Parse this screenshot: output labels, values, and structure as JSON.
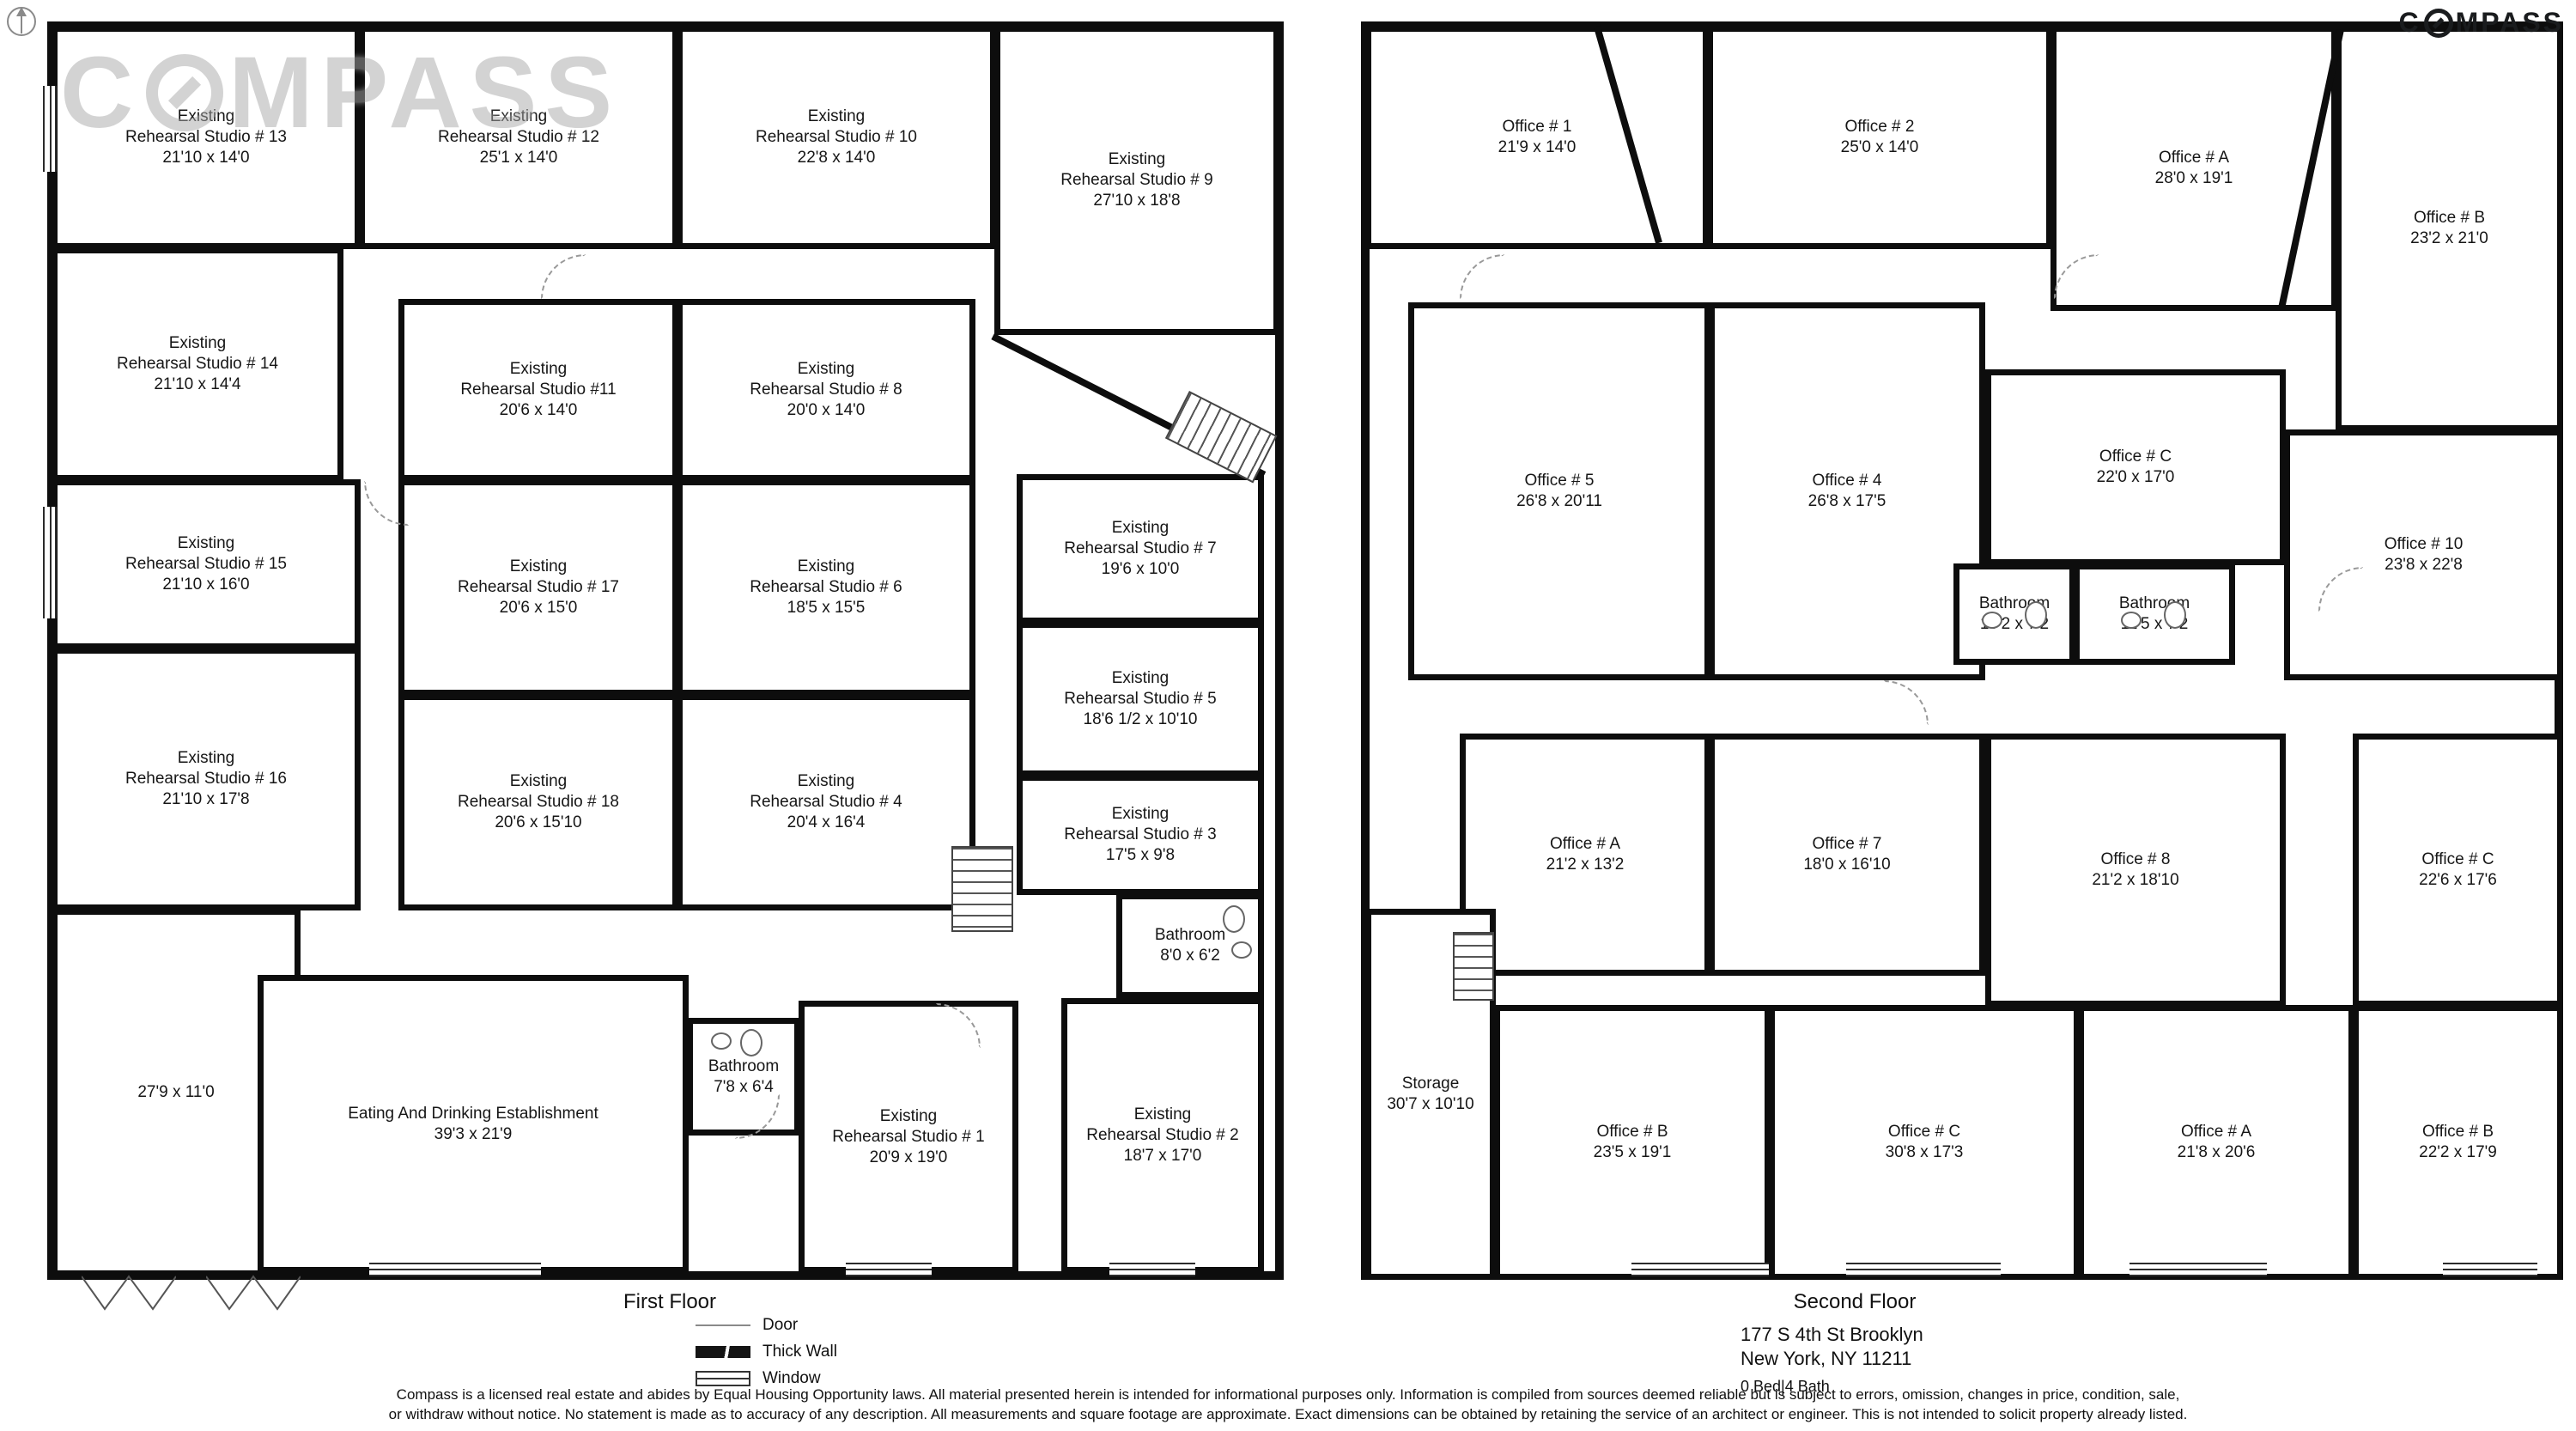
{
  "branding": {
    "wordmark_prefix": "C",
    "wordmark_suffix": "MPASS"
  },
  "first_floor": {
    "title": "First Floor",
    "rooms": {
      "studio13": "Existing\nRehearsal Studio # 13\n21'10 x 14'0",
      "studio12": "Existing\nRehearsal Studio # 12\n25'1 x 14'0",
      "studio10": "Existing\nRehearsal Studio # 10\n22'8 x 14'0",
      "studio9": "Existing\nRehearsal Studio # 9\n27'10 x 18'8",
      "studio14": "Existing\nRehearsal Studio # 14\n21'10 x 14'4",
      "studio15": "Existing\nRehearsal Studio # 15\n21'10 x 16'0",
      "studio16": "Existing\nRehearsal Studio # 16\n21'10 x 17'8",
      "room279": "27'9 x 11'0",
      "studio11": "Existing\nRehearsal Studio #11\n20'6 x 14'0",
      "studio17": "Existing\nRehearsal Studio # 17\n20'6 x 15'0",
      "studio18": "Existing\nRehearsal Studio # 18\n20'6 x 15'10",
      "studio8": "Existing\nRehearsal Studio # 8\n20'0 x 14'0",
      "studio6": "Existing\nRehearsal Studio # 6\n18'5 x 15'5",
      "studio4": "Existing\nRehearsal Studio # 4\n20'4 x 16'4",
      "studio7": "Existing\nRehearsal Studio # 7\n19'6 x 10'0",
      "studio5": "Existing\nRehearsal Studio # 5\n18'6 1/2 x 10'10",
      "studio3": "Existing\nRehearsal Studio # 3\n17'5 x 9'8",
      "bathroom_upper": "Bathroom\n8'0 x 6'2",
      "eating": "Eating And Drinking Establishment\n39'3 x 21'9",
      "bathroom_lower": "Bathroom\n7'8 x 6'4",
      "studio1": "Existing\nRehearsal Studio # 1\n20'9 x 19'0",
      "studio2": "Existing\nRehearsal Studio # 2\n18'7 x 17'0"
    }
  },
  "second_floor": {
    "title": "Second Floor",
    "rooms": {
      "office1": "Office # 1\n21'9 x 14'0",
      "office2": "Office # 2\n25'0 x 14'0",
      "officeA_top": "Office # A\n28'0 x 19'1",
      "officeB_top": "Office # B\n23'2 x 21'0",
      "office5": "Office # 5\n26'8 x 20'11",
      "office4": "Office # 4\n26'8 x 17'5",
      "officeC_top": "Office # C\n22'0 x 17'0",
      "office10": "Office # 10\n23'8 x 22'8",
      "bathroom_left": "Bathroom\n10'2 x 7'2",
      "bathroom_right": "Bathroom\n11'5 x 7'2",
      "officeA_mid": "Office # A\n21'2 x 13'2",
      "office7": "Office # 7\n18'0 x 16'10",
      "office8": "Office # 8\n21'2 x 18'10",
      "officeC_right": "Office # C\n22'6 x 17'6",
      "storage": "Storage\n30'7 x 10'10",
      "officeB_bottom": "Office # B\n23'5 x 19'1",
      "officeC_bottom": "Office # C\n30'8 x 17'3",
      "officeA_bottom": "Office # A\n21'8 x 20'6",
      "officeB_bottomright": "Office # B\n22'2 x 17'9"
    }
  },
  "legend": {
    "door": "Door",
    "thick_wall": "Thick Wall",
    "window": "Window"
  },
  "address": {
    "line1": "177 S 4th St Brooklyn",
    "line2": "New York, NY 11211",
    "beds_baths": "0 Bed|4 Bath"
  },
  "disclaimer": {
    "line1": "Compass is a licensed real estate and abides by Equal Housing Opportunity laws. All material presented herein is intended for informational purposes only. Information is compiled from sources deemed reliable but is subject to errors, omission, changes in price, condition, sale,",
    "line2": "or withdraw without notice. No statement is made as to accuracy of any description. All measurements and square footage are approximate. Exact dimensions can be obtained by retaining the service of an architect or engineer. This is not intended to solicit property already listed."
  }
}
